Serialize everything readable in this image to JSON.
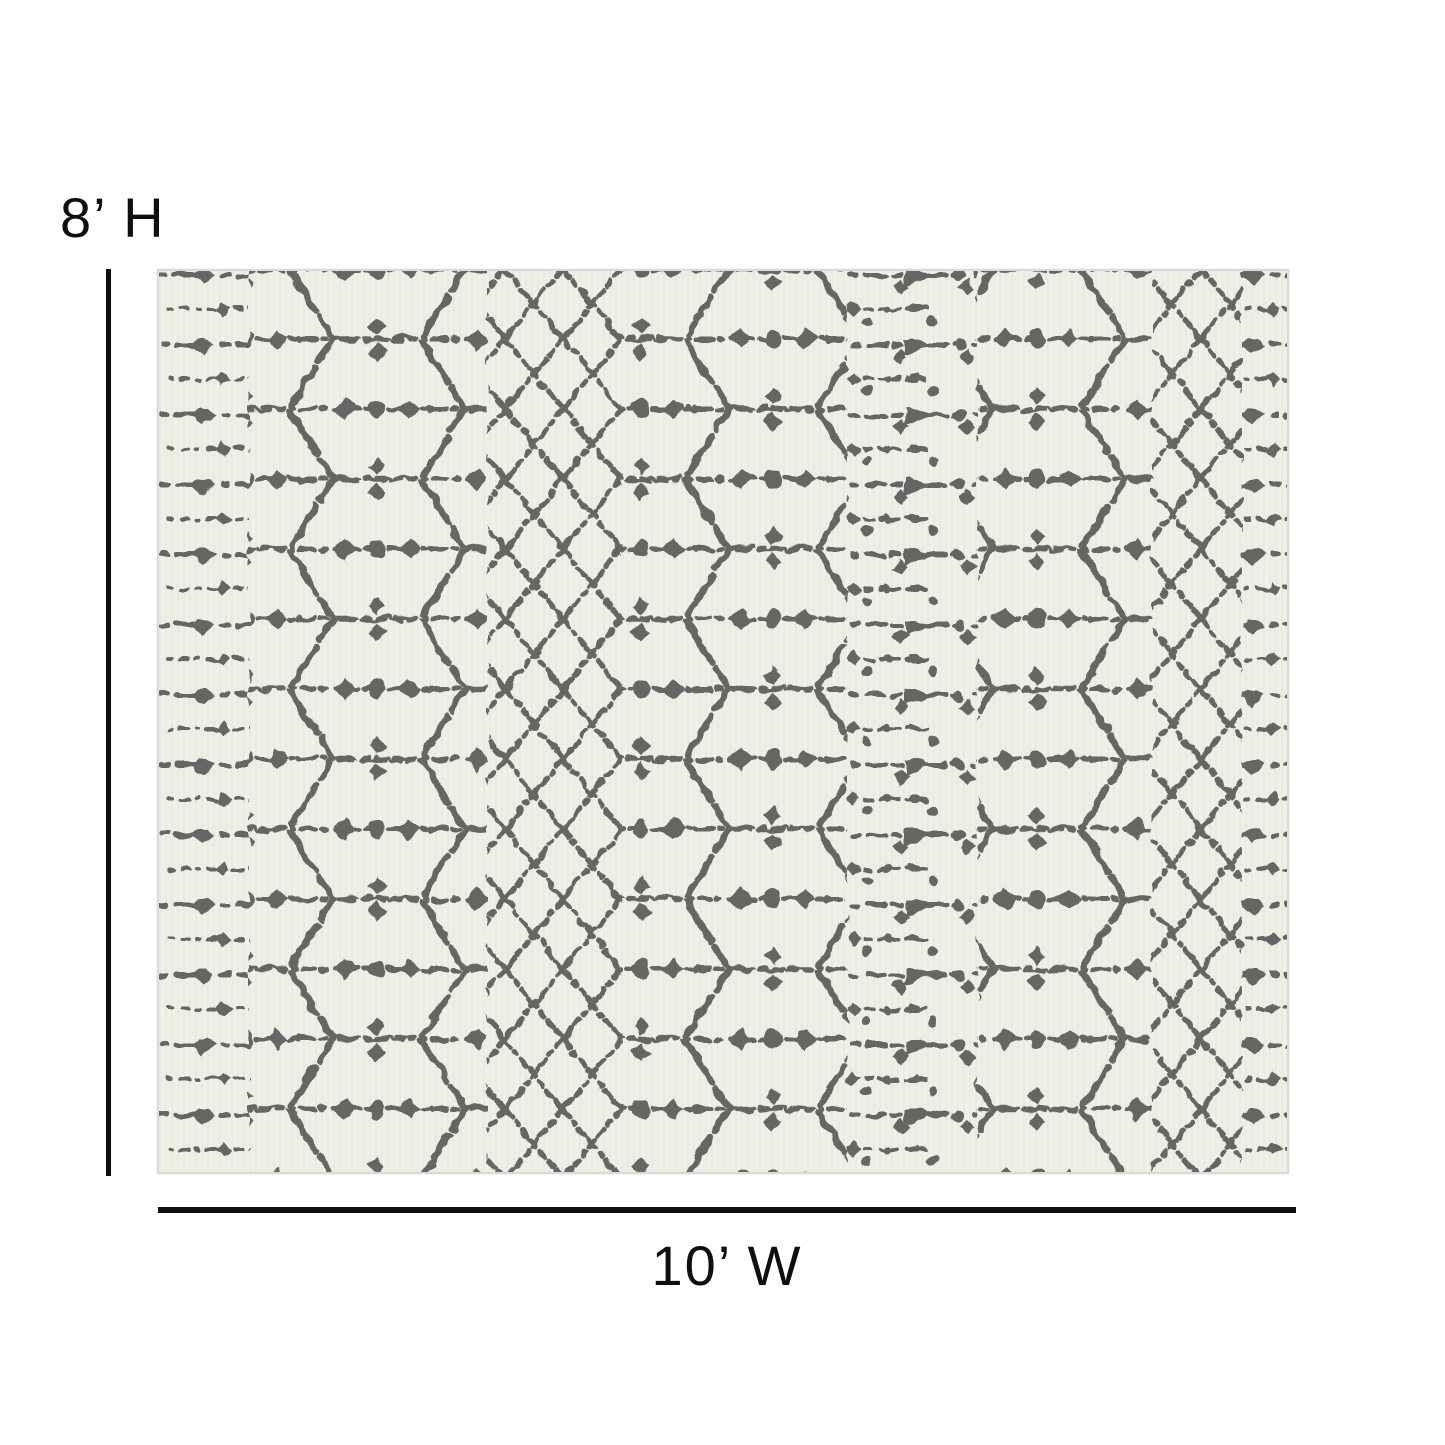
{
  "figure": {
    "height_label": "8’ H",
    "width_label": "10’ W"
  },
  "rug": {
    "style": "distressed-moroccan-lattice"
  },
  "colors": {
    "page_background": "#ffffff",
    "dimension": "#0f0f0f",
    "rug_background": "#efeee7",
    "rug_pattern": "#5d615d",
    "rug_edge": "#dcdad1"
  }
}
